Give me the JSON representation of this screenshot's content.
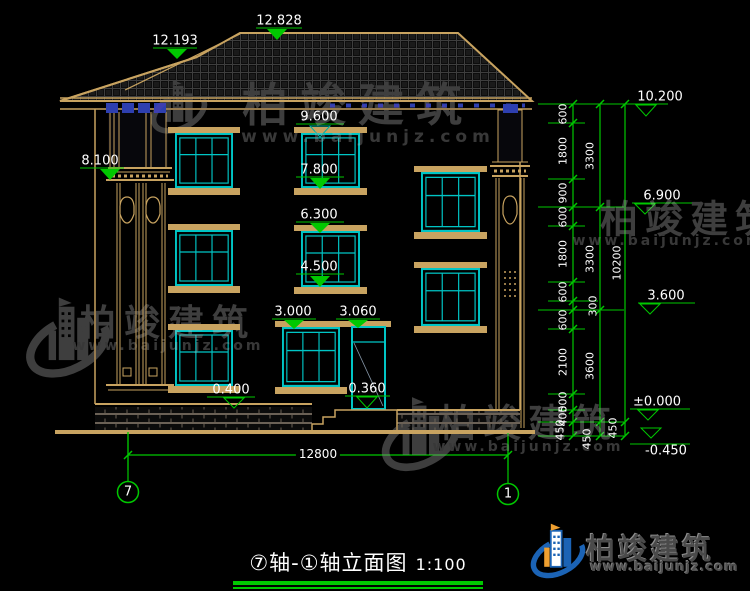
{
  "title": {
    "name": "⑦轴-①轴立面图",
    "scale": "1:100"
  },
  "axes": {
    "left": "7",
    "right": "1"
  },
  "bottom_dim": "12800",
  "elevations": {
    "ridge_main": "12.828",
    "ridge_porch": "12.193",
    "eave": "10.200",
    "porch_col_top": "8.100",
    "win3_top": "9.600",
    "win3_sill": "7.800",
    "floor3": "6.900",
    "win2_top": "6.300",
    "win2_sill": "4.500",
    "floor2": "3.600",
    "win1_top": "3.000",
    "door_top": "3.060",
    "base_top": "0.400",
    "door_sill": "0.360",
    "ground": "±0.000",
    "site": "-0.450"
  },
  "dim_chains": {
    "inner": [
      "600",
      "1800",
      "900",
      "600",
      "1800",
      "600",
      "300",
      "600",
      "2100",
      "500",
      "400",
      "450"
    ],
    "middle": [
      "3300",
      "3300",
      "3600",
      "450"
    ],
    "outer": [
      "10200",
      "450"
    ]
  },
  "watermark": {
    "brand": "柏竣建筑",
    "url": "www.baijunjz.com"
  },
  "logo": {
    "brand": "柏竣建筑",
    "url": "www.baijunjz.com"
  }
}
